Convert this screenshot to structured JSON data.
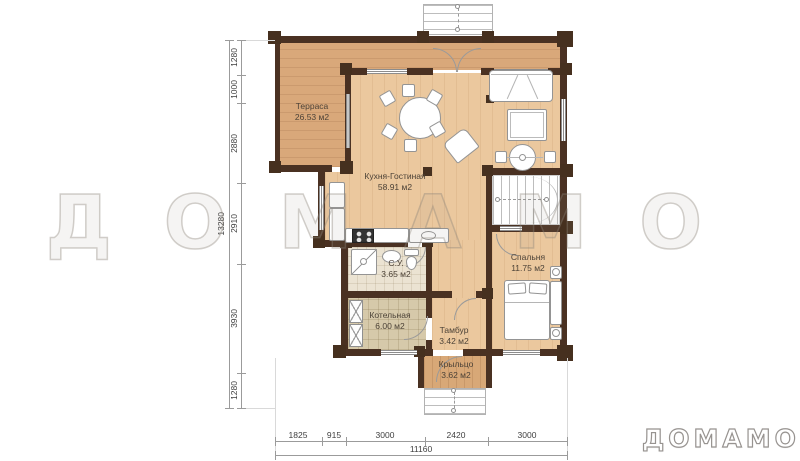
{
  "watermark": "ДОМАМО",
  "logo": "ДОМАМО",
  "rooms": [
    {
      "name": "Терраса",
      "area": "26.53 м2"
    },
    {
      "name": "Кухня-Гостиная",
      "area": "58.91 м2"
    },
    {
      "name": "С.У.",
      "area": "3.65 м2"
    },
    {
      "name": "Котельная",
      "area": "6.00 м2"
    },
    {
      "name": "Тамбур",
      "area": "3.42 м2"
    },
    {
      "name": "Спальня",
      "area": "11.75 м2"
    },
    {
      "name": "Крыльцо",
      "area": "3.62 м2"
    }
  ],
  "dimensions": {
    "left": {
      "segments": [
        "1280",
        "1000",
        "2880",
        "2910",
        "3930",
        "1280"
      ],
      "total": "13280"
    },
    "bottom": {
      "segments": [
        "1825",
        "915",
        "3000",
        "2420",
        "3000"
      ],
      "total": "11160"
    }
  },
  "colors": {
    "wall": "#4a3122",
    "terrace_floor": "#d9a87a",
    "room_floor": "#ebc89e",
    "boiler_floor": "#d6c9aa",
    "bathroom_floor": "#ebe3d2",
    "porch_floor": "#d8a877"
  }
}
